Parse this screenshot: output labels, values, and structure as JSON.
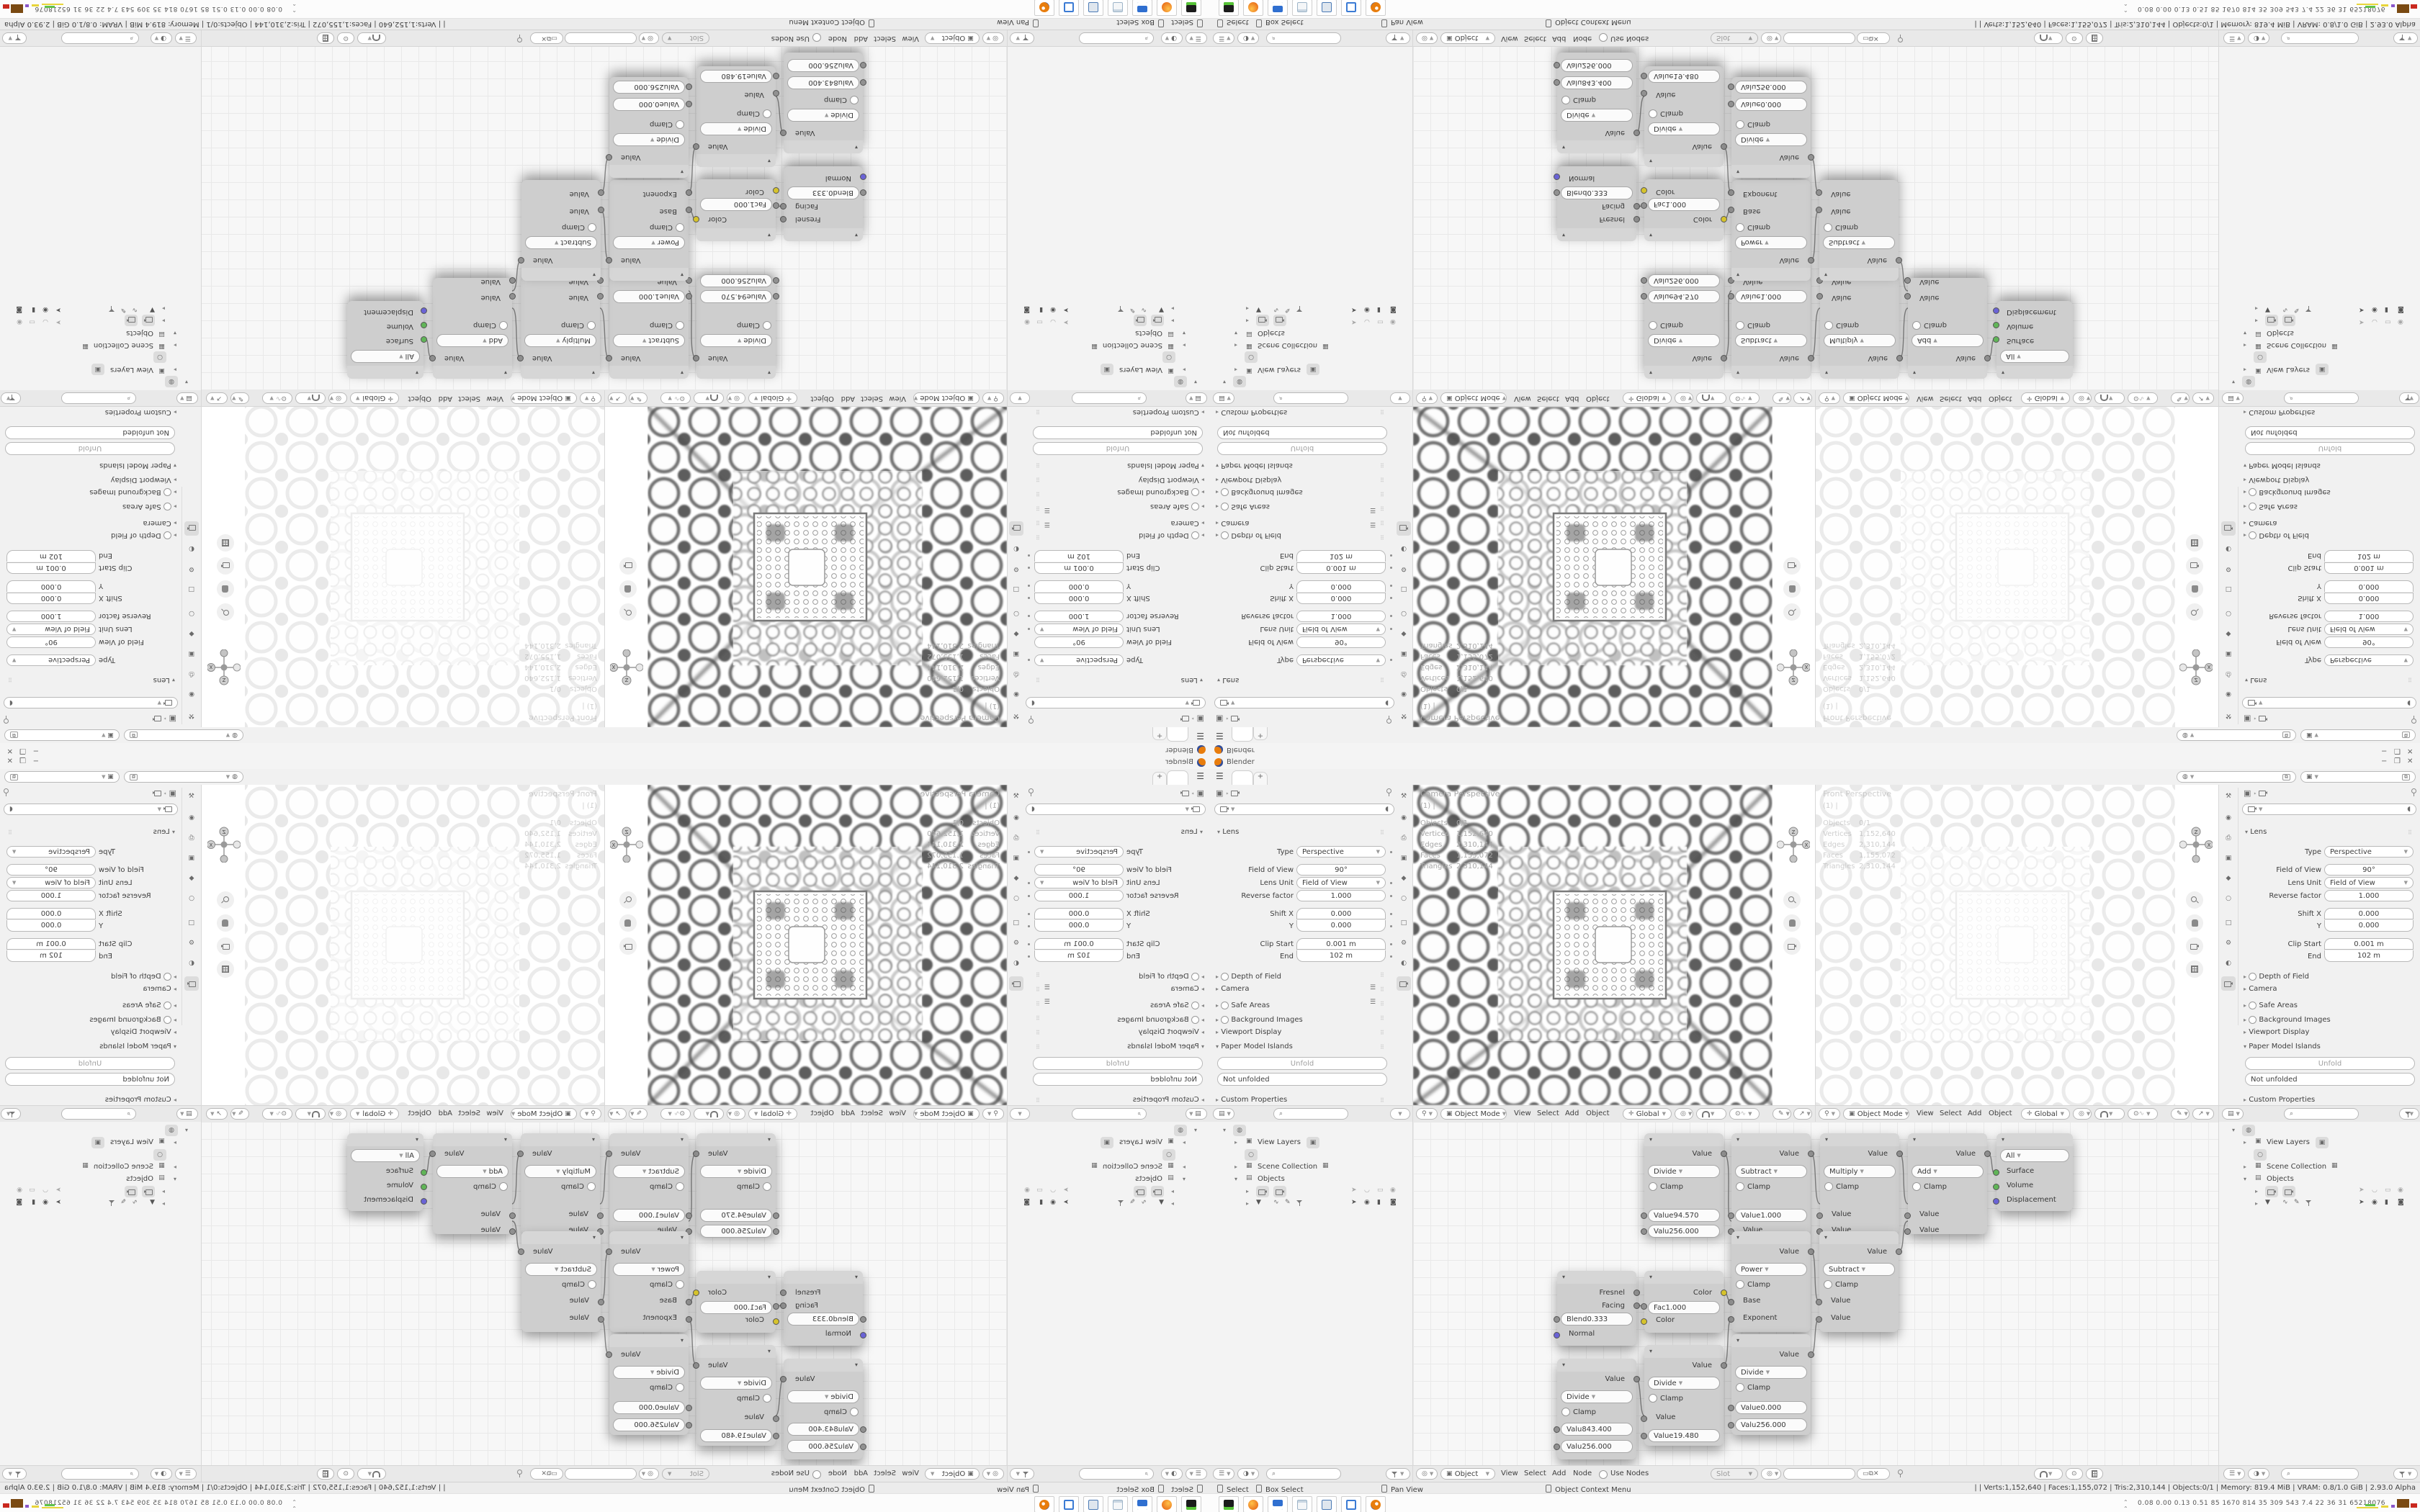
{
  "app": {
    "title": "Blender",
    "min": "−",
    "max": "❐",
    "close": "✕",
    "new_tab": "+",
    "hamburger": "☰"
  },
  "props": {
    "lens": "Lens",
    "type_l": "Type",
    "type_v": "Perspective",
    "fov_l": "Field of View",
    "fov_v": "90°",
    "unit_l": "Lens Unit",
    "unit_v": "Field of View",
    "rev_l": "Reverse factor",
    "rev_v": "1.000",
    "sx_l": "Shift X",
    "sx_v": "0.000",
    "sy_l": "Y",
    "sy_v": "0.000",
    "cs_l": "Clip Start",
    "cs_v": "0.001 m",
    "ce_l": "End",
    "ce_v": "102 m",
    "dof": "Depth of Field",
    "camera": "Camera",
    "safe": "Safe Areas",
    "bg": "Background Images",
    "vd": "Viewport Display",
    "pmi": "Paper Model Islands",
    "unfold": "Unfold",
    "notunf": "Not unfolded",
    "custom": "Custom Properties"
  },
  "vp": {
    "mode": "Object Mode",
    "m1": "View",
    "m2": "Select",
    "m3": "Add",
    "m4": "Object",
    "orient": "Global",
    "cam_label": "Camera Perspective",
    "front_label": "Front Perspective",
    "frame": "(1) |",
    "s1l": "Objects",
    "s1v": "0/1",
    "s2l": "Vertices",
    "s2v": "1,152,640",
    "s3l": "Edges",
    "s3v": "2,310,144",
    "s4l": "Faces",
    "s4v": "1,155,072",
    "s5l": "Triangles",
    "s5v": "2,310,144"
  },
  "outliner": {
    "vl": "View Layers",
    "sc": "Scene Collection",
    "ob": "Objects"
  },
  "shader": {
    "m1": "View",
    "m2": "Select",
    "m3": "Add",
    "m4": "Node",
    "use": "Use Nodes",
    "slot": "Slot",
    "mode": "Object",
    "value": "Value",
    "clamp": "Clamp",
    "n1": {
      "op": "Divide",
      "a_l": "Value",
      "a_v": "94.570",
      "b_l": "Valu",
      "b_v": "256.000"
    },
    "n2": {
      "op": "Subtract",
      "a_l": "Value",
      "a_v": "1.000"
    },
    "n3": {
      "op": "Multiply"
    },
    "n4": {
      "op": "Add"
    },
    "out": {
      "target": "All",
      "s1": "Surface",
      "s2": "Volume",
      "s3": "Displacement"
    },
    "n5": {
      "op": "Power",
      "a": "Base",
      "b": "Exponent"
    },
    "n6": {
      "op": "Subtract"
    },
    "lw": {
      "o1": "Fresnel",
      "o2": "Facing",
      "blend_l": "Blend",
      "blend_v": "0.333",
      "normal": "Normal"
    },
    "inv": {
      "out": "Color",
      "fac_l": "Fac",
      "fac_v": "1.000",
      "cin": "Color"
    },
    "n7": {
      "op": "Divide",
      "a_l": "Valu",
      "a_v": "843.400",
      "b_l": "Valu",
      "b_v": "256.000"
    },
    "n8": {
      "op": "Divide",
      "a": "Value",
      "b_l": "Value",
      "b_v": "19.480"
    },
    "n9": {
      "op": "Divide",
      "a_l": "Value",
      "a_v": "0.000",
      "b_l": "Valu",
      "b_v": "256.000"
    }
  },
  "status": {
    "h1": "Select",
    "h2": "Box Select",
    "h3": "Pan View",
    "h4": "Object Context Menu",
    "right": "|  | Verts:1,152,640 | Faces:1,155,072 | Tris:2,310,144 | Objects:0/1 | Memory: 819.4 MiB | VRAM: 0.8/1.0 GiB | 2.93.0 Alpha"
  },
  "taskbar": {
    "stats": "0.08 0.00 0.13 0.51   85   1670 814   35   309  543   7.4   22   36   31  65218076"
  }
}
